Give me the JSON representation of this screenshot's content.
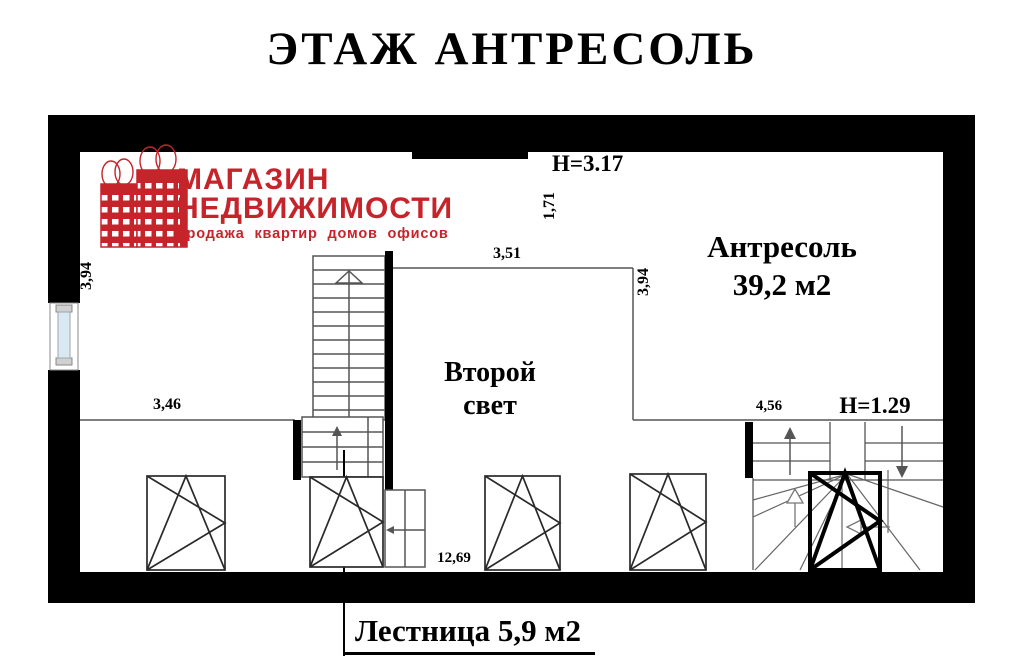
{
  "title": "ЭТАЖ АНТРЕСОЛЬ",
  "logo": {
    "line1": "МАГАЗИН",
    "line2": "НЕДВИЖИМОСТИ",
    "tagline": "продажа квартир домов офисов",
    "color": "#c6242b"
  },
  "rooms": {
    "mezzanine": {
      "name": "Антресоль",
      "area": "39,2 м2"
    },
    "second_light": {
      "line1": "Второй",
      "line2": "свет"
    },
    "staircase": {
      "label": "Лестница 5,9 м2"
    }
  },
  "dimensions": {
    "ceiling_height_main": "H=3.17",
    "ceiling_height_right": "H=1.29",
    "width_1_71": "1,71",
    "width_3_51": "3,51",
    "depth_3_94_left": "3,94",
    "depth_3_94_right": "3,94",
    "width_3_46": "3,46",
    "width_4_56": "4,56",
    "width_12_69": "12,69"
  },
  "colors": {
    "wall": "#000000",
    "thin_line": "#555555",
    "window_stroke": "#2a2a2a",
    "logo_red": "#c6242b",
    "window_pane": "#dae8f2"
  }
}
